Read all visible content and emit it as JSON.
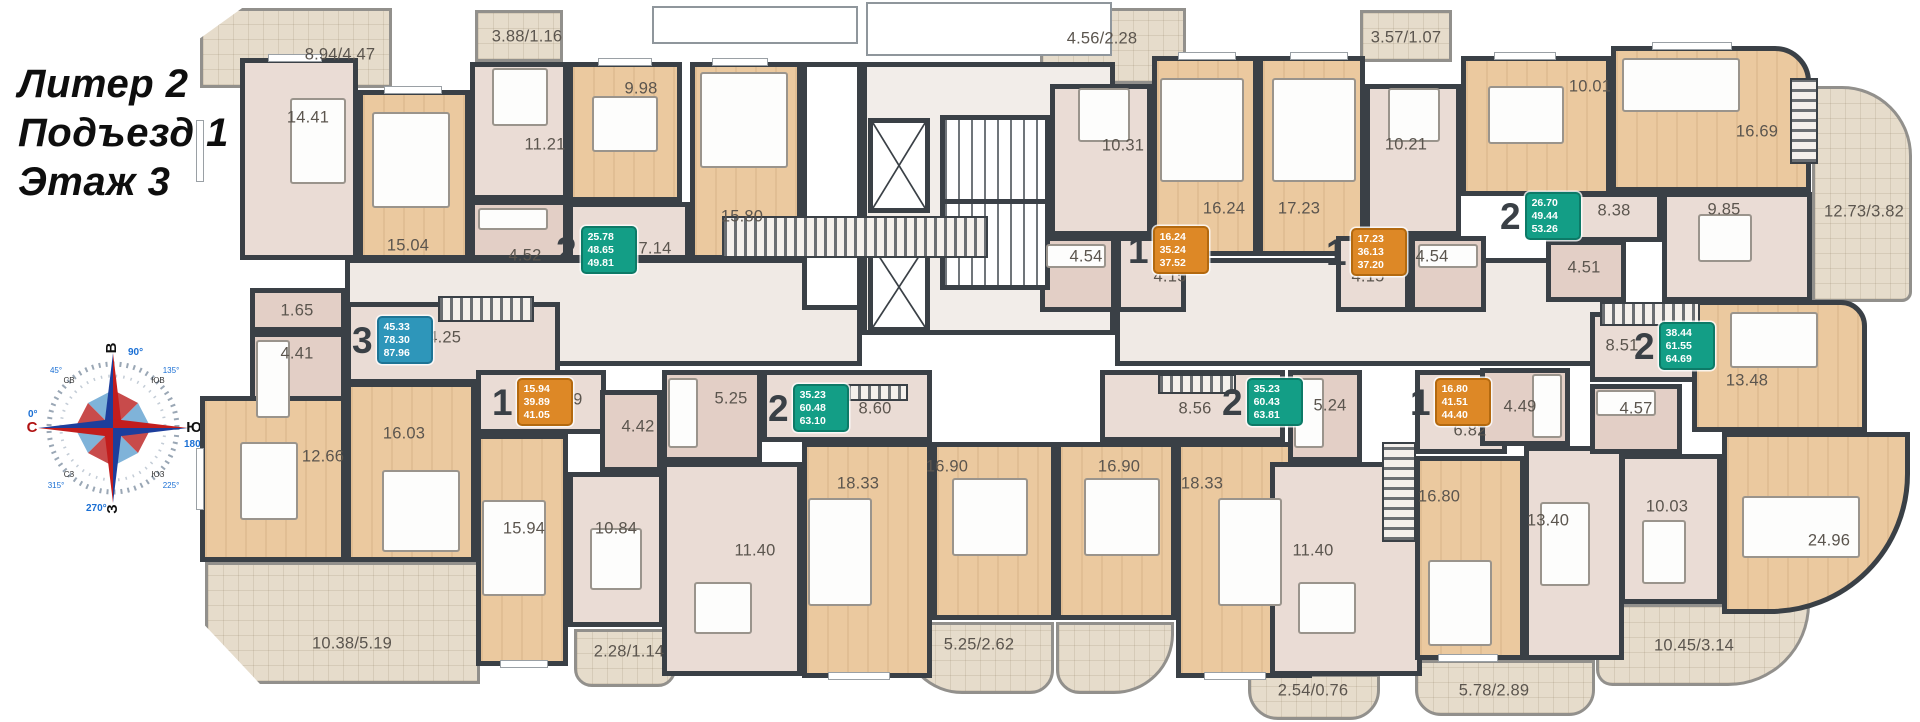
{
  "header": {
    "building": "Литер 2",
    "entrance": "Подъезд 1",
    "floor": "Этаж 3"
  },
  "compass": {
    "e": "В",
    "s": "Ю",
    "w": "З",
    "n": "С",
    "deg_e": "90°",
    "deg_s": "180°",
    "deg_w": "270°",
    "deg_n": "0°",
    "ne": "СВ",
    "se": "ЮВ",
    "sw": "ЮЗ",
    "nw": "СЗ",
    "deg_ne": "45°",
    "deg_se": "135°",
    "deg_sw": "225°",
    "deg_nw": "315°"
  },
  "palette": {
    "wall": "#3a4046",
    "wood_floor": "#ebc99f",
    "tile_floor": "#eadcd5",
    "bath_floor": "#e3cfc6",
    "balcony_floor": "#e6dccb",
    "badge_teal": "#139e86",
    "badge_orange": "#dd8826",
    "badge_blue": "#2e96ba"
  },
  "apartments": {
    "a1": {
      "num": "2",
      "living": "25.78",
      "total": "48.65",
      "total_balcony": "49.81"
    },
    "a2": {
      "num": "3",
      "living": "45.33",
      "total": "78.30",
      "total_balcony": "87.96"
    },
    "a3": {
      "num": "1",
      "living": "16.24",
      "total": "35.24",
      "total_balcony": "37.52"
    },
    "a4": {
      "num": "1",
      "living": "17.23",
      "total": "36.13",
      "total_balcony": "37.20"
    },
    "a5": {
      "num": "2",
      "living": "26.70",
      "total": "49.44",
      "total_balcony": "53.26"
    },
    "a6": {
      "num": "2",
      "living": "38.44",
      "total": "61.55",
      "total_balcony": "64.69"
    },
    "a7": {
      "num": "1",
      "living": "15.94",
      "total": "39.89",
      "total_balcony": "41.05"
    },
    "a8": {
      "num": "2",
      "living": "35.23",
      "total": "60.48",
      "total_balcony": "63.10"
    },
    "a9": {
      "num": "2",
      "living": "35.23",
      "total": "60.43",
      "total_balcony": "63.81"
    },
    "a10": {
      "num": "1",
      "living": "16.80",
      "total": "41.51",
      "total_balcony": "44.40"
    }
  },
  "rooms": {
    "r1": "8.94/4.47",
    "r2": "14.41",
    "r3": "15.04",
    "r4": "3.88/1.16",
    "r5": "11.21",
    "r6": "4.52",
    "r7": "9.98",
    "r8": "7.14",
    "r9": "15.80",
    "r10": "4.56/2.28",
    "r11": "10.31",
    "r12": "16.24",
    "r13": "17.23",
    "r14": "4.54",
    "r15": "4.15",
    "r16": "3.57/1.07",
    "r17": "10.21",
    "r18": "4.54",
    "r19": "4.15",
    "r20": "10.01",
    "r21": "16.69",
    "r22": "8.38",
    "r23": "9.85",
    "r24": "4.51",
    "r25": "12.73/3.82",
    "r26": "1.65",
    "r27": "4.41",
    "r28": "14.25",
    "r29": "16.03",
    "r30": "12.66",
    "r31": "10.38/5.19",
    "r32": "8.69",
    "r33": "4.42",
    "r34": "15.94",
    "r35": "10.84",
    "r36": "2.28/1.14",
    "r37": "5.25",
    "r38": "8.60",
    "r39": "11.40",
    "r40": "18.33",
    "r41": "16.90",
    "r42": "5.25/2.62",
    "r43": "16.90",
    "r44": "18.33",
    "r45": "11.40",
    "r46": "8.56",
    "r47": "5.24",
    "r48": "2.54/0.76",
    "r49": "6.82",
    "r50": "4.49",
    "r51": "16.80",
    "r52": "13.40",
    "r53": "5.78/2.89",
    "r54": "8.51",
    "r55": "13.48",
    "r56": "4.57",
    "r57": "10.03",
    "r58": "24.96",
    "r59": "10.45/3.14"
  }
}
